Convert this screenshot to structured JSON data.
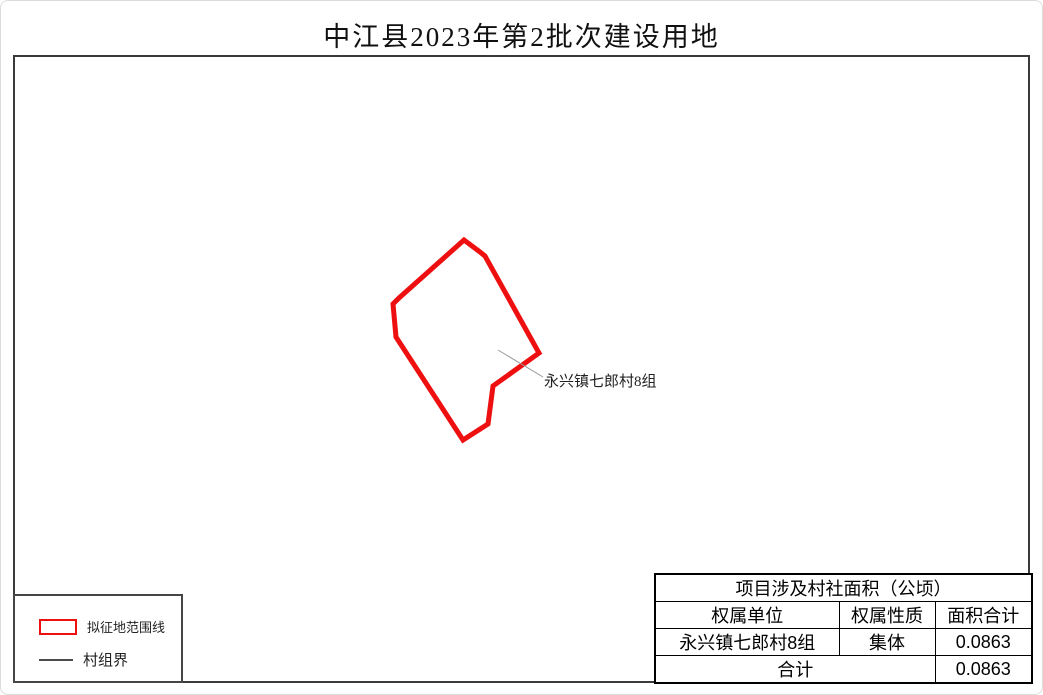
{
  "title": "中江县2023年第2批次建设用地",
  "map": {
    "parcel_label": "永兴镇七郎村8组"
  },
  "legend": {
    "items": [
      {
        "label": "拟征地范围线",
        "swatch": "red-rectangle-outline"
      },
      {
        "label": "村组界",
        "swatch": "gray-line"
      }
    ]
  },
  "table": {
    "title": "项目涉及村社面积（公顷）",
    "headers": [
      "权属单位",
      "权属性质",
      "面积合计"
    ],
    "rows": [
      [
        "永兴镇七郎村8组",
        "集体",
        "0.0863"
      ]
    ],
    "total_label": "合计",
    "total_value": "0.0863"
  },
  "colors": {
    "parcel_outline": "#ee1010",
    "leader_line": "#999999",
    "frame_border": "#3a3a3a",
    "table_border": "#000000"
  }
}
